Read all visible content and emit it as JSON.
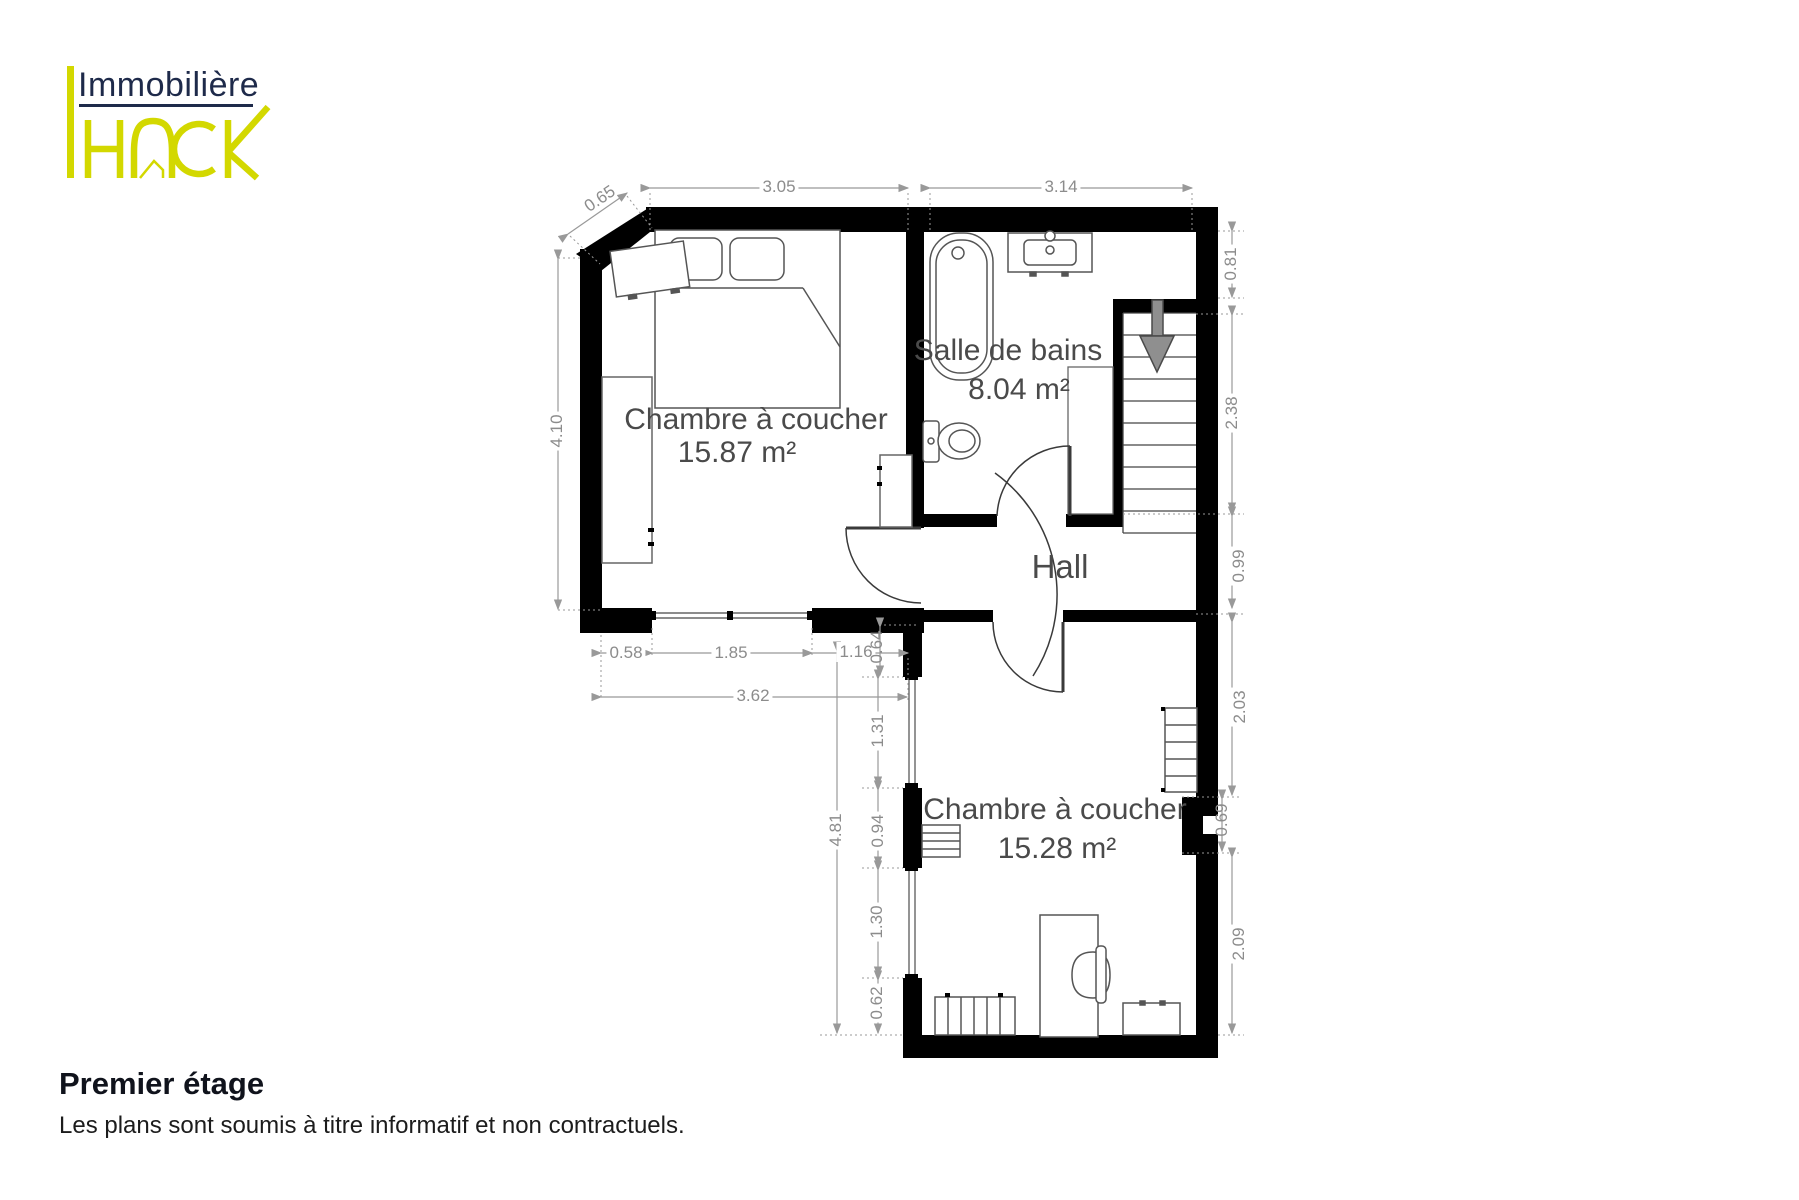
{
  "logo": {
    "line1": "Immobilière",
    "brand": "HACK"
  },
  "rooms": {
    "bedroom1": {
      "name": "Chambre à coucher",
      "area": "15.87 m²"
    },
    "bathroom": {
      "name": "Salle de bains",
      "area": "8.04 m²"
    },
    "hall": {
      "name": "Hall"
    },
    "bedroom2": {
      "name": "Chambre à coucher",
      "area": "15.28 m²"
    }
  },
  "dimensions": {
    "diag": "0.65",
    "top_bedroom1": "3.05",
    "top_bathroom": "3.14",
    "left_bedroom1": "4.10",
    "right_1": "0.81",
    "right_2": "2.38",
    "right_3": "0.99",
    "right_4": "2.03",
    "right_5": "0.69",
    "right_6": "2.09",
    "win_row_a": "0.58",
    "win_row_b": "1.85",
    "win_row_c": "1.16",
    "offset_small": "0.64",
    "total_width": "3.62",
    "side_1": "1.31",
    "side_2": "0.94",
    "side_3": "1.30",
    "side_4": "0.62",
    "total_height": "4.81"
  },
  "icons": {
    "stairs_arrow": "down-arrow"
  },
  "footer": {
    "title": "Premier étage",
    "disclaimer": "Les plans sont soumis à titre informatif et non contractuels."
  },
  "colors": {
    "wall": "#000000",
    "dimension": "#8c8c8c",
    "room_text": "#4a4a4a",
    "logo_navy": "#1e2a4a",
    "logo_yellow": "#d3d800",
    "stairs_arrow": "#8f8f8f"
  }
}
